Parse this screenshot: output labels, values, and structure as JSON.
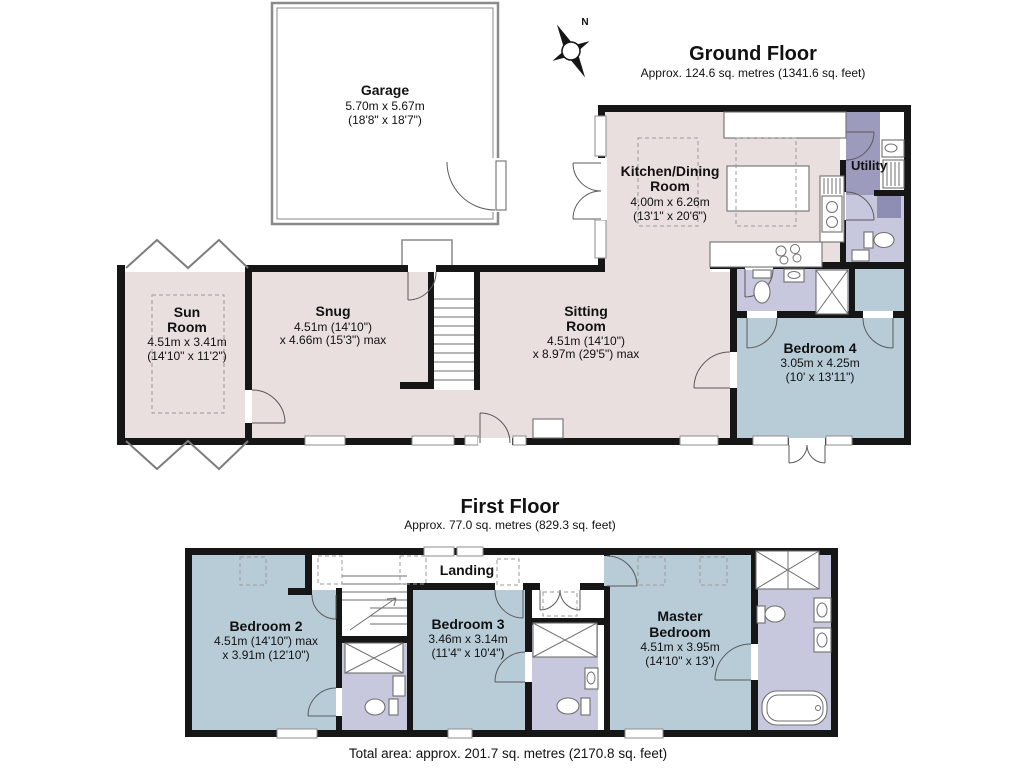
{
  "ground_floor": {
    "title": "Ground Floor",
    "subtitle": "Approx. 124.6 sq. metres (1341.6 sq. feet)",
    "compass_label": "N",
    "rooms": {
      "garage": {
        "lines": [
          "Garage",
          "5.70m x 5.67m",
          "(18'8\" x 18'7\")"
        ]
      },
      "kitchen_dining": {
        "lines": [
          "Kitchen/Dining",
          "Room",
          "4.00m x 6.26m",
          "(13'1\" x 20'6\")"
        ]
      },
      "utility": {
        "lines": [
          "Utility"
        ]
      },
      "sun_room": {
        "lines": [
          "Sun",
          "Room",
          "4.51m x 3.41m",
          "(14'10\" x 11'2\")"
        ]
      },
      "snug": {
        "lines": [
          "Snug",
          "4.51m (14'10\")",
          "x 4.66m (15'3\") max"
        ]
      },
      "sitting_room": {
        "lines": [
          "Sitting",
          "Room",
          "4.51m (14'10\")",
          "x 8.97m (29'5\") max"
        ]
      },
      "bedroom_4": {
        "lines": [
          "Bedroom 4",
          "3.05m x 4.25m",
          "(10' x 13'11\")"
        ]
      }
    }
  },
  "first_floor": {
    "title": "First Floor",
    "subtitle": "Approx. 77.0 sq. metres (829.3 sq. feet)",
    "rooms": {
      "landing": {
        "lines": [
          "Landing"
        ]
      },
      "bedroom_2": {
        "lines": [
          "Bedroom 2",
          "4.51m (14'10\") max",
          "x 3.91m (12'10\")"
        ]
      },
      "bedroom_3": {
        "lines": [
          "Bedroom 3",
          "3.46m x 3.14m",
          "(11'4\" x 10'4\")"
        ]
      },
      "master_bedroom": {
        "lines": [
          "Master",
          "Bedroom",
          "4.51m x 3.95m",
          "(14'10\" x 13')"
        ]
      }
    }
  },
  "footer": {
    "total_area": "Total area: approx. 201.7 sq. metres (2170.8 sq. feet)"
  },
  "colors": {
    "living_pink": "#e9dfde",
    "bedroom_blue": "#b8ccd8",
    "bathroom_lavender": "#c7c7dd",
    "utility_purple": "#9c9bbe",
    "wall_black": "#161616"
  }
}
